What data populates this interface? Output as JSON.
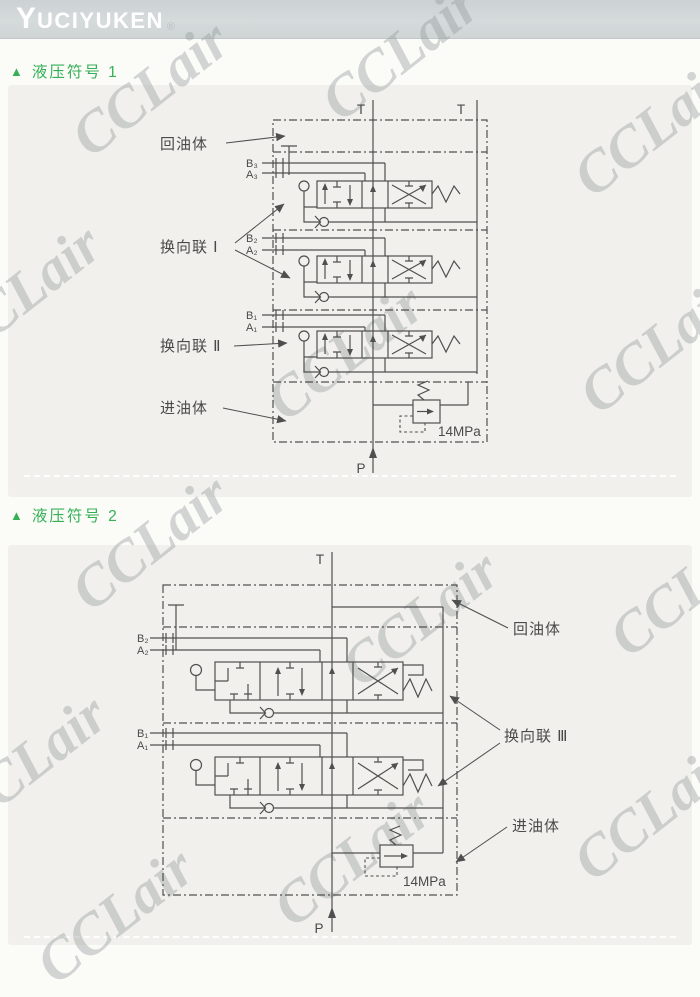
{
  "header": {
    "brand_initial": "Y",
    "brand_rest": "UCIYUKEN",
    "registered": "®"
  },
  "watermark": {
    "text": "CCLair"
  },
  "sections": [
    {
      "marker": "▲",
      "title": "液压符号 1"
    },
    {
      "marker": "▲",
      "title": "液压符号 2"
    }
  ],
  "diagram1": {
    "ports": {
      "t_left": "T",
      "t_right": "T",
      "p": "P",
      "b3": "B₃",
      "a3": "A₃",
      "b2": "B₂",
      "a2": "A₂",
      "b1": "B₁",
      "a1": "A₁"
    },
    "labels": {
      "return_body": "回油体",
      "section_1": "换向联 Ⅰ",
      "section_2": "换向联 Ⅱ",
      "inlet_body": "进油体",
      "relief_pressure": "14MPa"
    }
  },
  "diagram2": {
    "ports": {
      "t": "T",
      "p": "P",
      "b2": "B₂",
      "a2": "A₂",
      "b1": "B₁",
      "a1": "A₁"
    },
    "labels": {
      "return_body": "回油体",
      "section_3": "换向联 Ⅲ",
      "inlet_body": "进油体",
      "relief_pressure": "14MPa"
    }
  }
}
